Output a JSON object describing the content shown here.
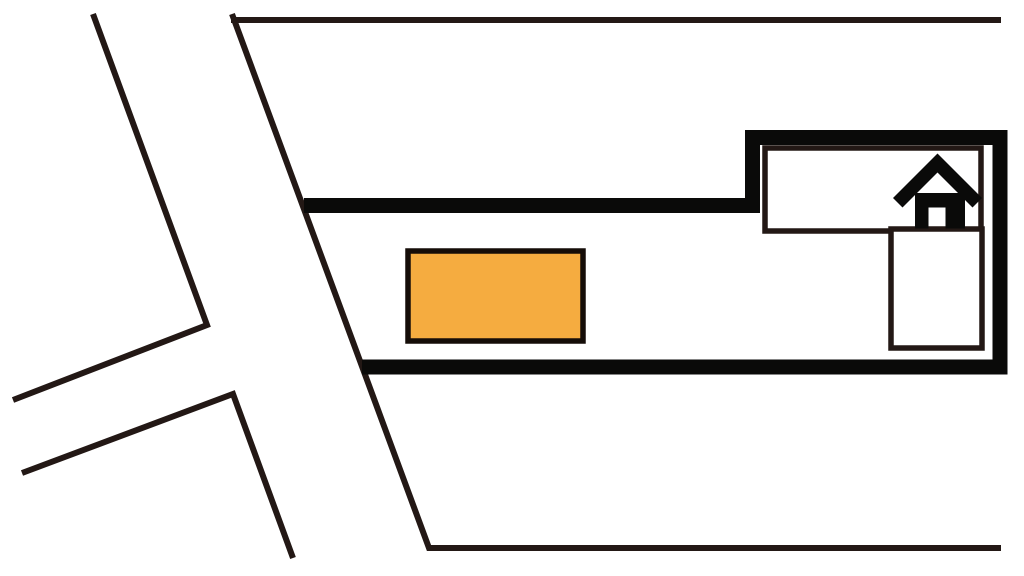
{
  "map": {
    "description": "parking-location-sketch-map",
    "background": "#ffffff",
    "colors": {
      "road_line": "#231815",
      "lot_boundary": "#0a0a09",
      "building_outline": "#231815",
      "building_fill": "#ffffff",
      "house_icon": "#0a0a09",
      "parking_space_fill": "#f5ac40",
      "parking_space_border": "#150d08"
    },
    "shapes": {
      "road_fork_upper": {
        "points": "93,14 207,325 13,400"
      },
      "road_fork_lower": {
        "points": "22,473 233,394 293,558"
      },
      "main_road_edge": {
        "points": "232,14 429,548 1001,548"
      },
      "top_road_edge": {
        "points": "231,20 1001,20"
      },
      "lot_boundary": {
        "points": "304,205.5 752.5,205.5 752.5,137.5 1000,137.5 1000,367 362,367"
      },
      "building_upper_wing": {
        "x": 765,
        "y": 148,
        "width": 216,
        "height": 83
      },
      "building_lower_wing": {
        "x": 891,
        "y": 229,
        "width": 91,
        "height": 119
      },
      "parking_space": {
        "x": 408,
        "y": 251,
        "width": 175,
        "height": 90
      },
      "house_roof": {
        "d": "M 937.5,153.5 L 982,198 L 972.5,207.5 L 937.5,172.5 L 902.5,207.5 L 893,198 Z"
      },
      "house_body": {
        "d": "M 915,193 L 965,193 L 965,228.5 L 945.5,228.5 L 945.5,207.5 L 928.5,207.5 L 928.5,228.5 L 915,228.5 Z"
      }
    }
  }
}
